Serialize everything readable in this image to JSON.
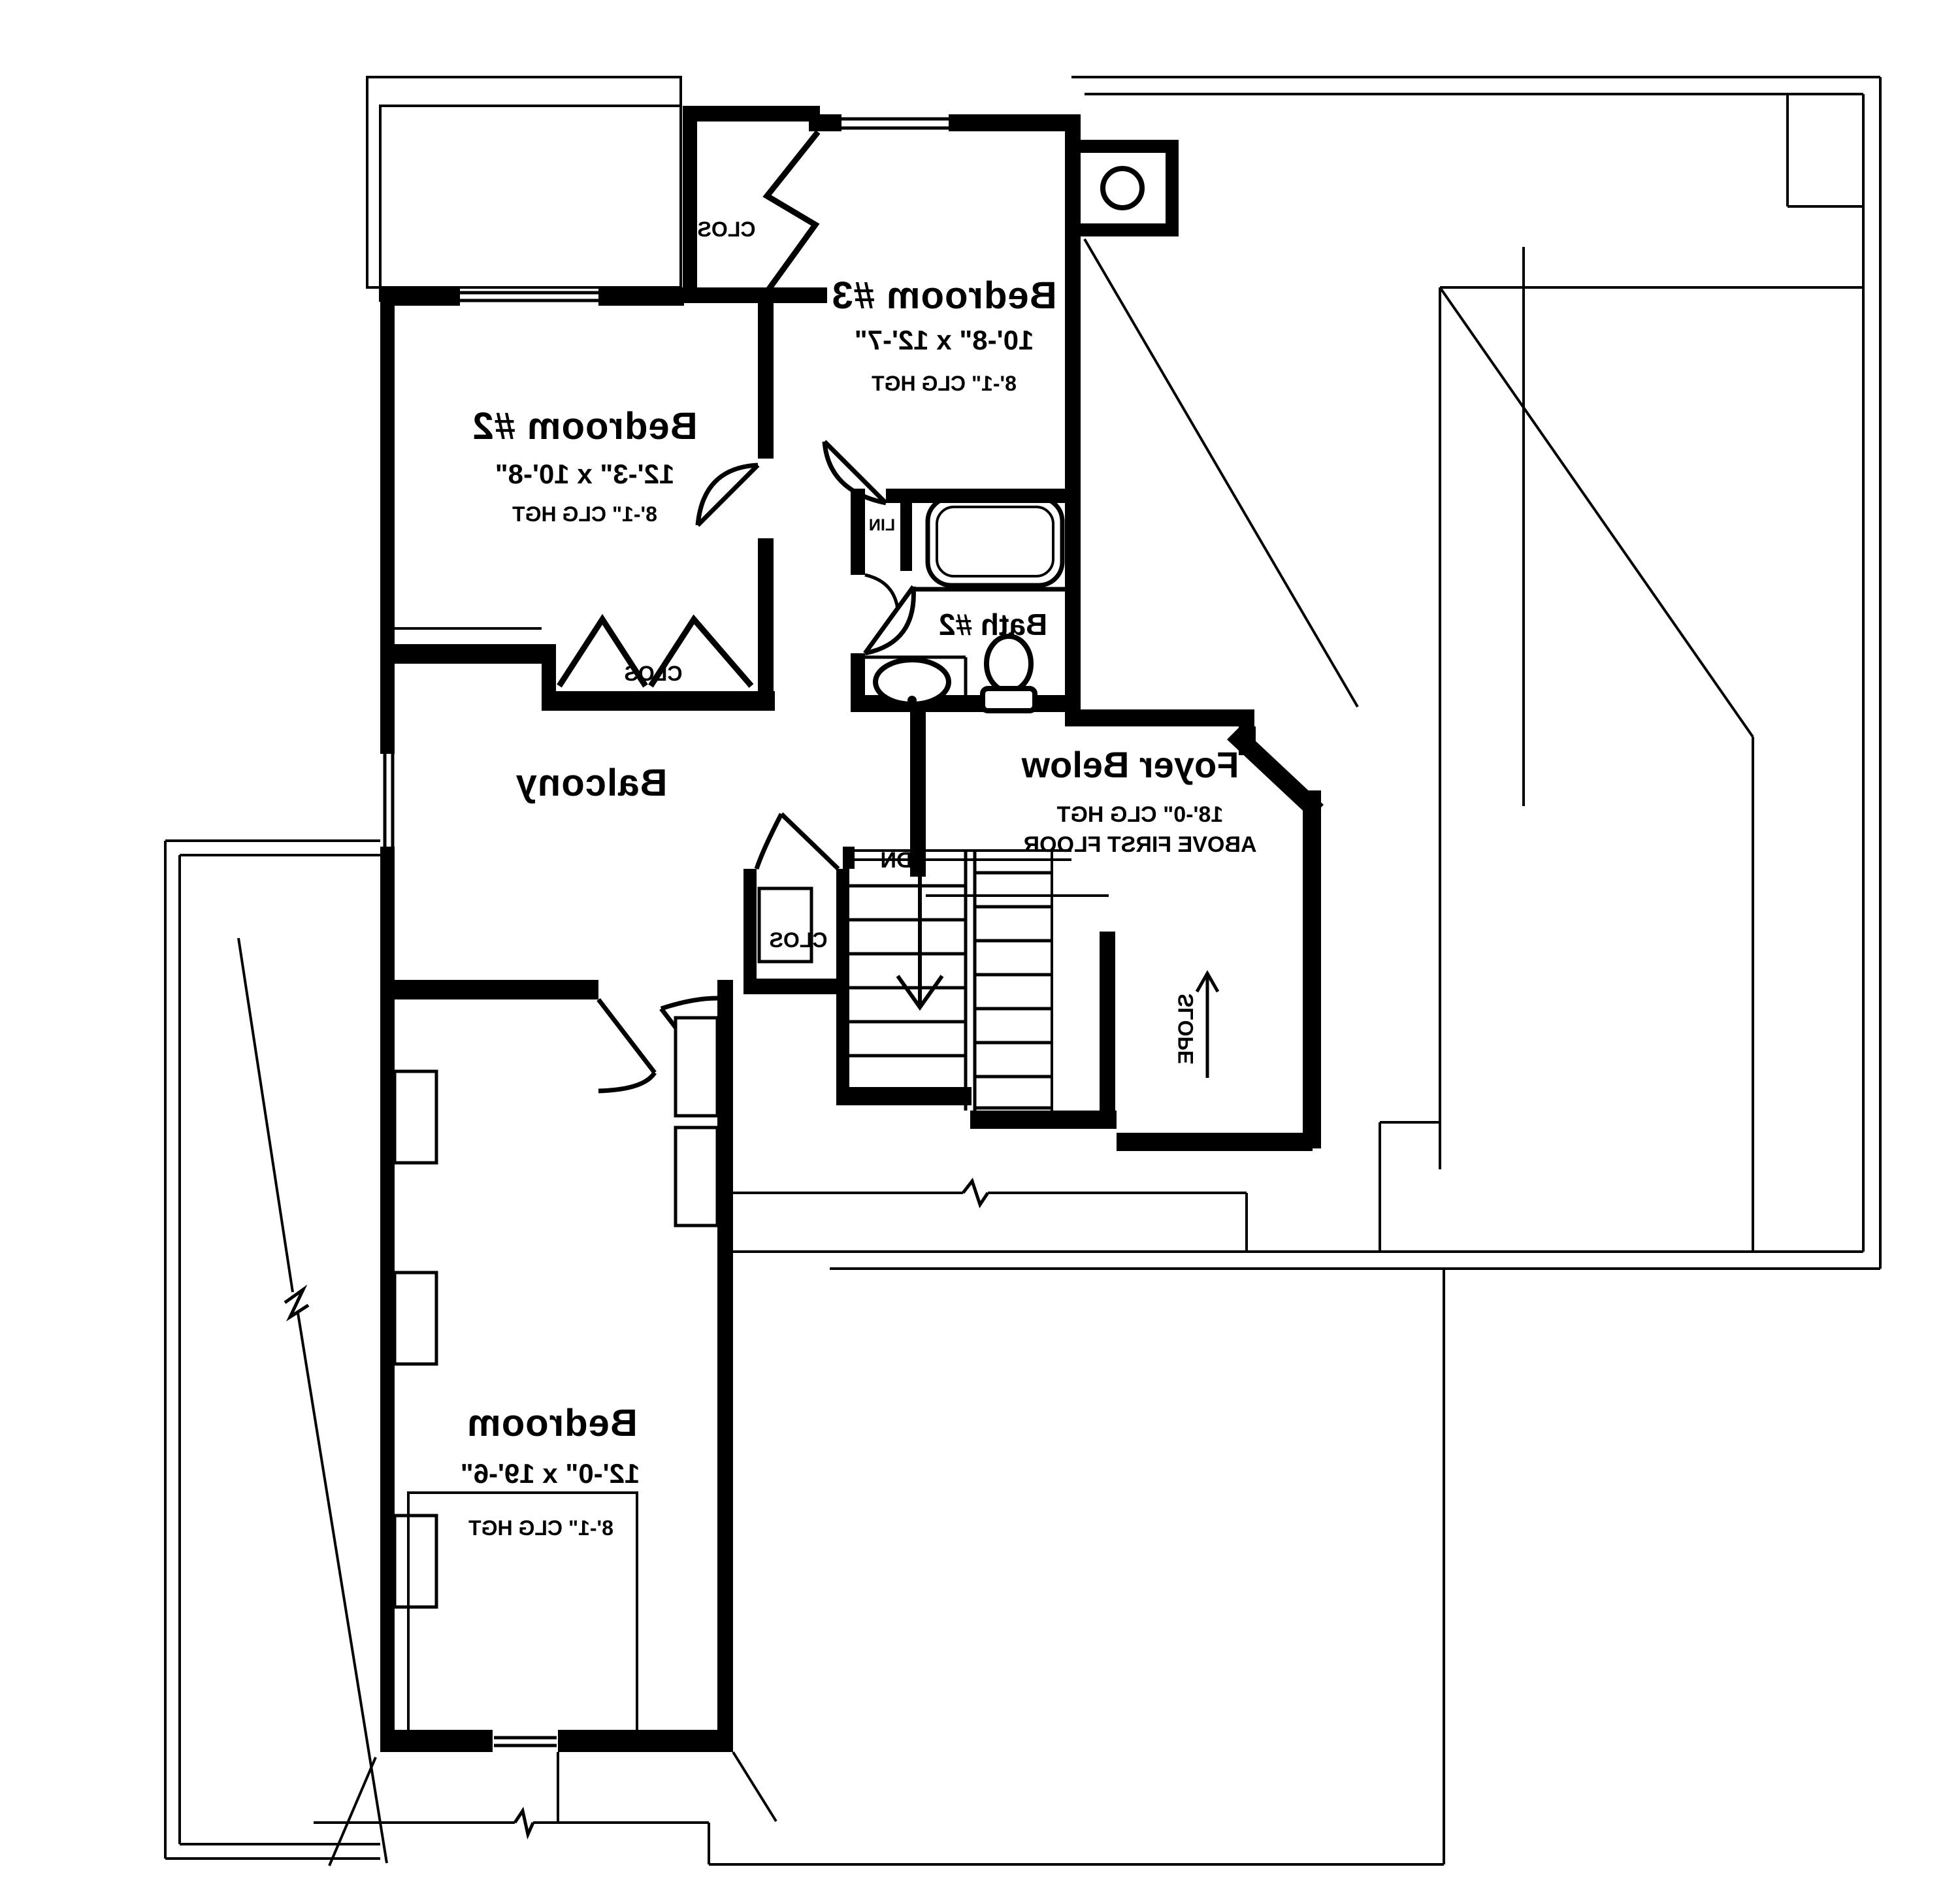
{
  "plan": {
    "rooms": {
      "bedroom3": {
        "name": "Bedroom #3",
        "dims": "10'-8\" x 12'-7\"",
        "ceiling": "8'-1\" CLG HGT"
      },
      "bedroom2": {
        "name": "Bedroom #2",
        "dims": "12'-3\" x 10'-8\"",
        "ceiling": "8'-1\" CLG HGT"
      },
      "master": {
        "name": "Bedroom",
        "dims": "12'-0\" x 19'-6\"",
        "ceiling": "8'-1\" CLG HGT"
      },
      "bath2": {
        "name": "Bath #2"
      },
      "foyer": {
        "name": "Foyer Below",
        "ceiling": "18'-0\" CLG HGT",
        "note": "ABOVE FIRST FLOOR"
      },
      "balcony": {
        "name": "Balcony"
      }
    },
    "labels": {
      "closet": "CLOS",
      "linen": "LIN",
      "down": "DN",
      "slope": "SLOPE"
    },
    "colors": {
      "ink": "#000000",
      "paper": "#ffffff"
    }
  }
}
